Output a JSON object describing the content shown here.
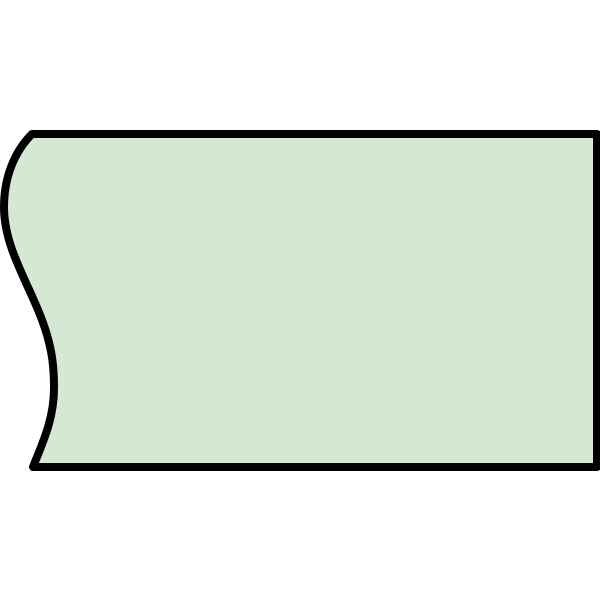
{
  "canvas": {
    "width": 600,
    "height": 600,
    "background_color": "#ffffff"
  },
  "shape": {
    "name": "bar-with-break-line",
    "fill_color": "#d5e8d4",
    "stroke_color": "#000000",
    "stroke_width": 8,
    "path": "M 32 134 C 14 152 4 178 4 207 C 4 252 34 290 47 335 C 52 352 54 367 54 388 C 54 420 42 444 33 467 L 597 467 L 597 134 Z"
  }
}
